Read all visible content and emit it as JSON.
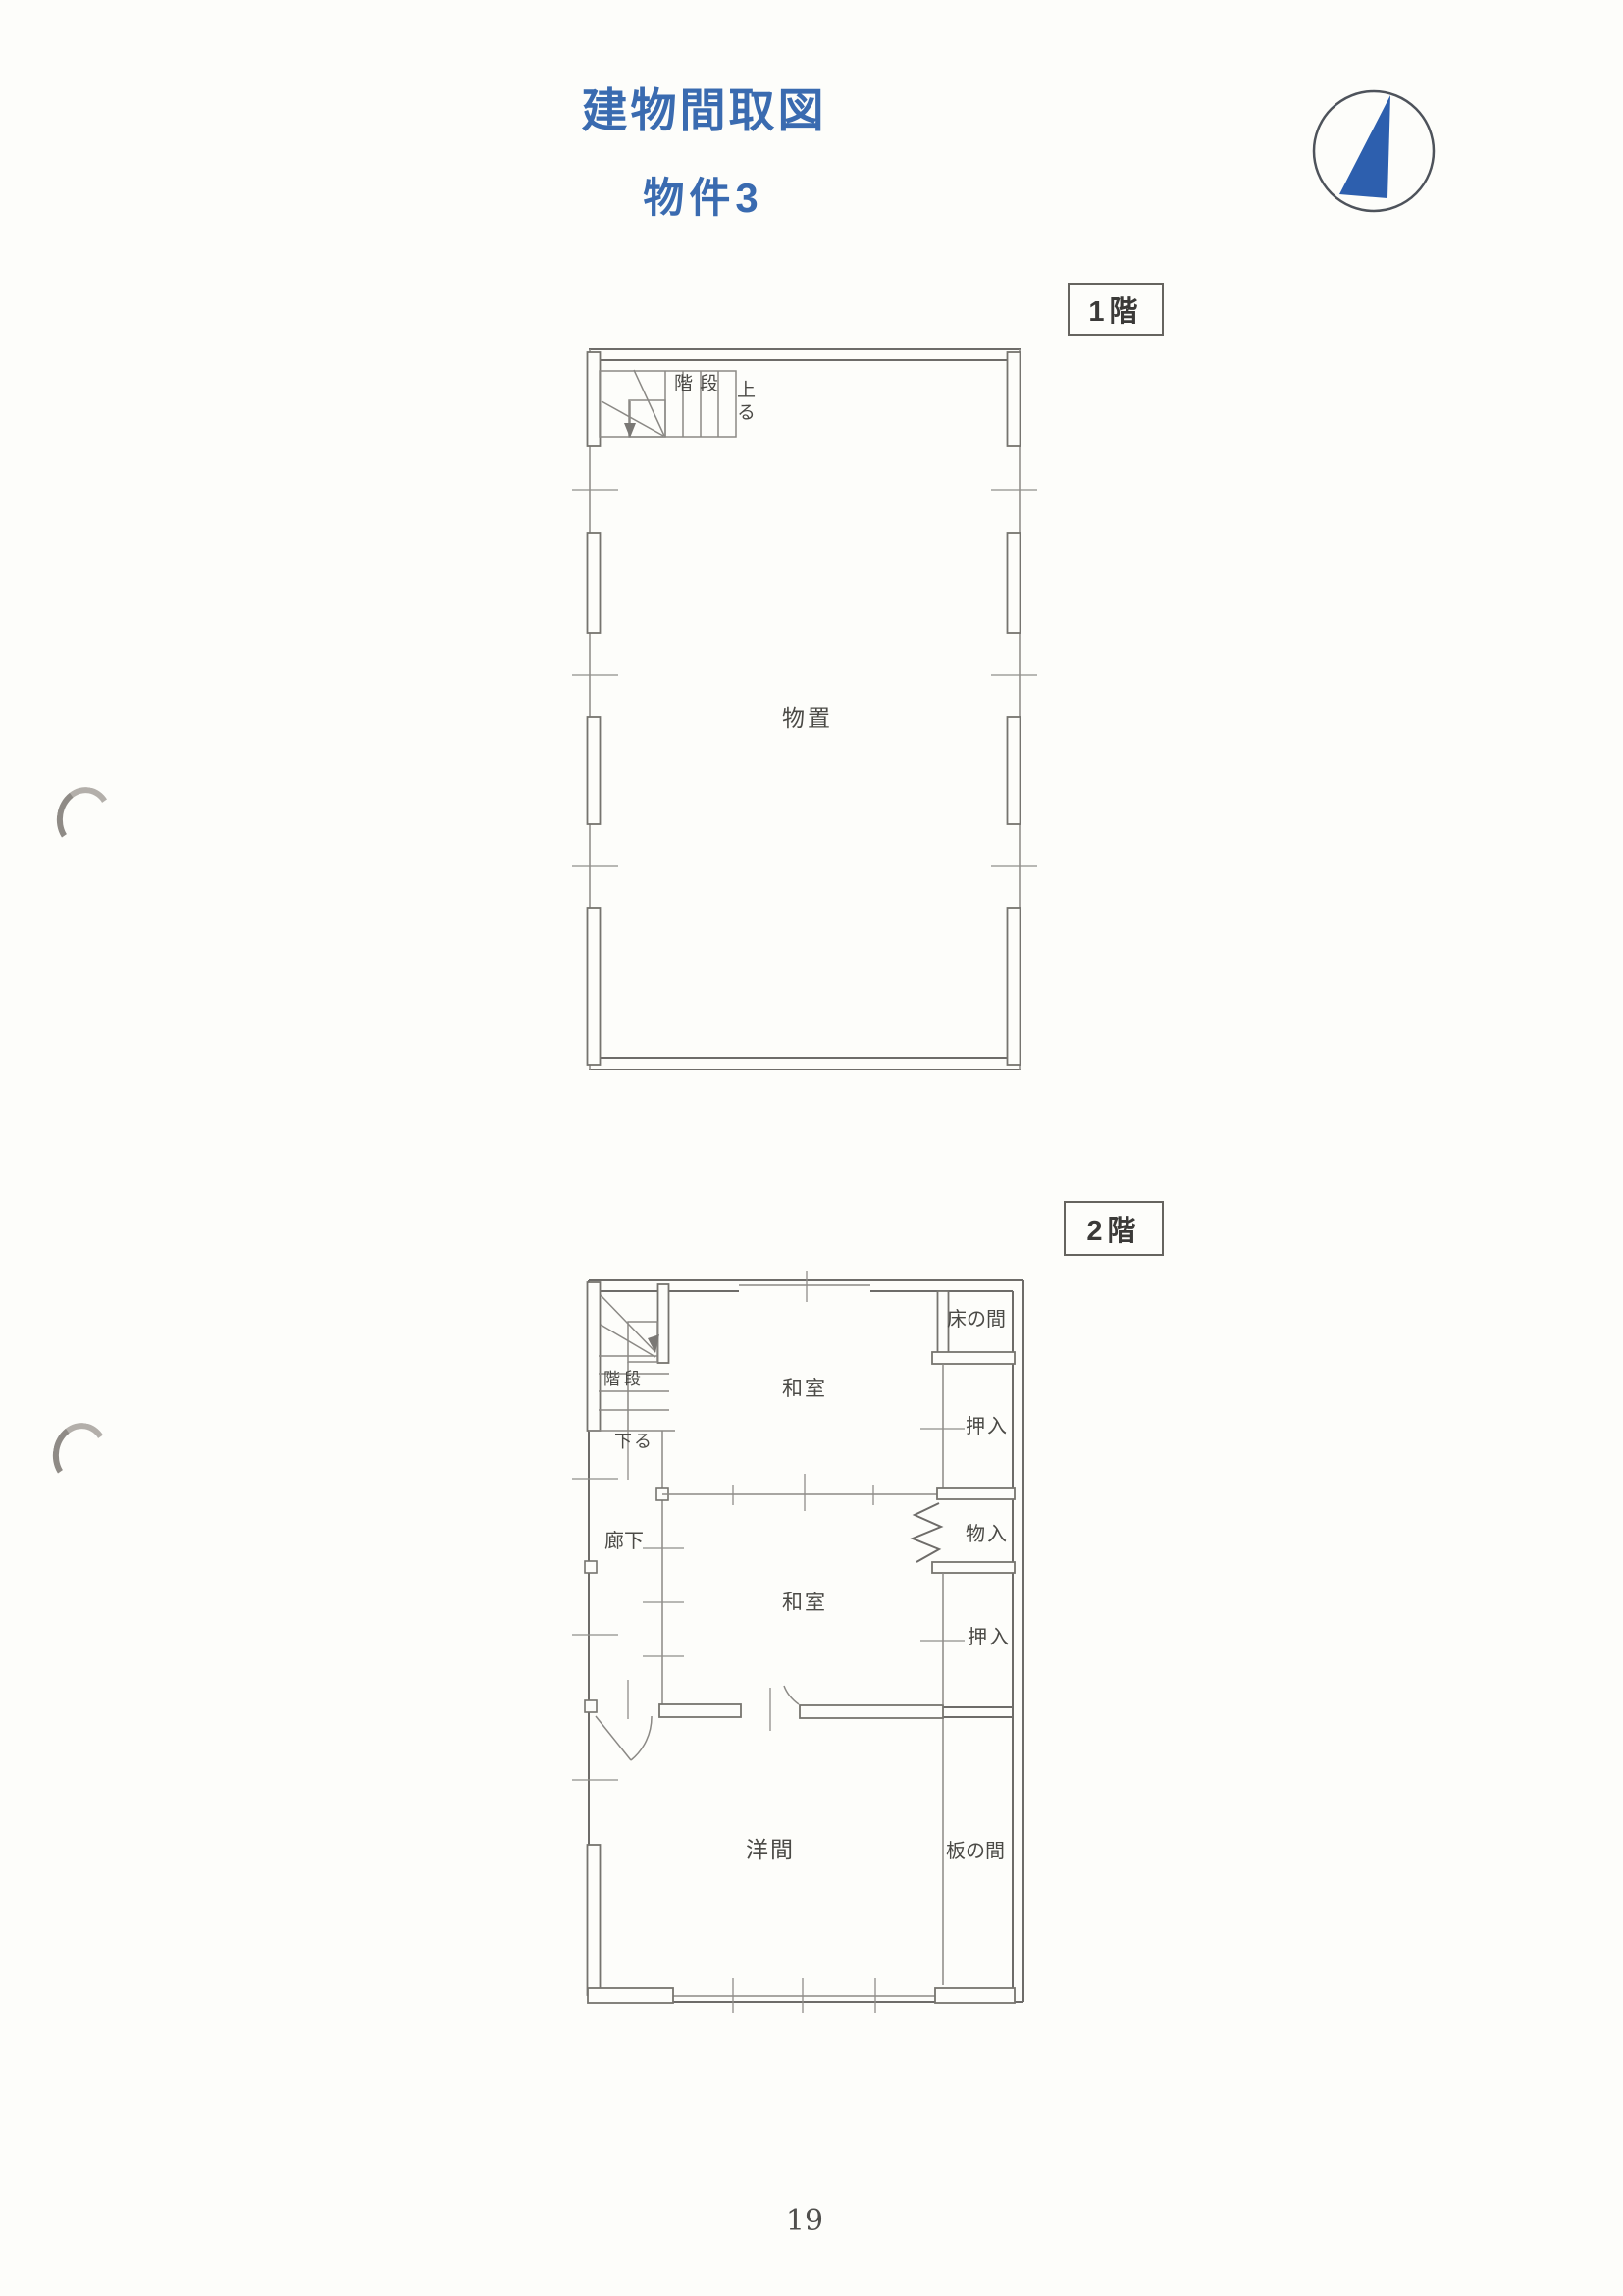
{
  "page": {
    "title": "建物間取図",
    "subtitle": "物件3",
    "page_number": "19"
  },
  "colors": {
    "accent_blue": "#3a6bb0",
    "compass_blue": "#2d5fae",
    "line_gray": "#6e6c69",
    "label_gray": "#4b4a46"
  },
  "floor1": {
    "badge": "1階",
    "stairs": {
      "label": "階段",
      "direction": "上る"
    },
    "rooms": [
      {
        "id": "monooki",
        "label": "物置"
      }
    ]
  },
  "floor2": {
    "badge": "2階",
    "stairs": {
      "label": "階段",
      "direction": "下る"
    },
    "rooms": [
      {
        "id": "corridor",
        "label": "廊下"
      },
      {
        "id": "washitsu-upper",
        "label": "和室"
      },
      {
        "id": "tokonoma",
        "label": "床の間"
      },
      {
        "id": "oshiire-upper",
        "label": "押入"
      },
      {
        "id": "monoire",
        "label": "物入"
      },
      {
        "id": "washitsu-middle",
        "label": "和室"
      },
      {
        "id": "oshiire-middle",
        "label": "押入"
      },
      {
        "id": "youma",
        "label": "洋間"
      },
      {
        "id": "itanoma",
        "label": "板の間"
      }
    ]
  }
}
